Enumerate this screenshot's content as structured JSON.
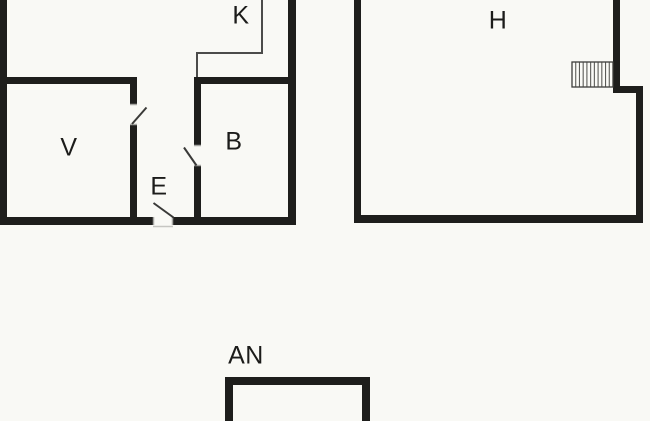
{
  "colors": {
    "background": "#f9f9f5",
    "wall": "#1e1e1c",
    "partition_line": "#4c4c4a",
    "door_line": "#3a3a38",
    "jamb_cap": "#a6a6a2",
    "stair_hatch": "#5c5c58"
  },
  "floorplan": {
    "labels": {
      "k": "K",
      "v": "V",
      "b": "B",
      "e": "E",
      "h": "H",
      "an": "AN"
    },
    "stairs": {
      "treads": 11
    }
  }
}
